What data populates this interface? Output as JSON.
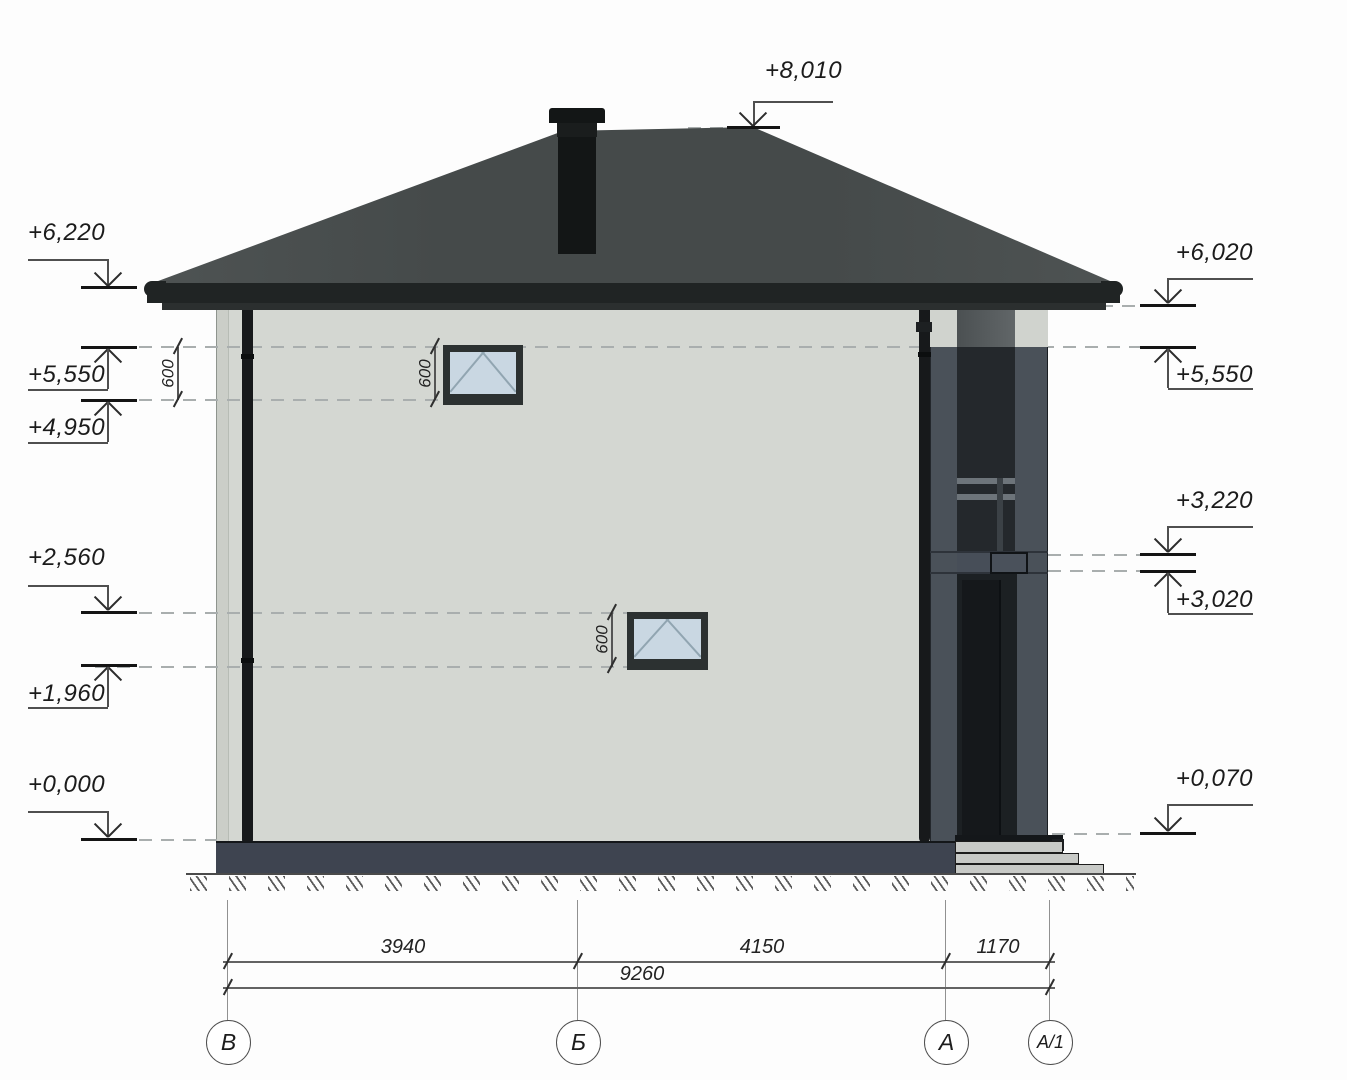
{
  "document": {
    "type": "architectural elevation drawing",
    "subject": "two-storey house side elevation with hip roof, chimney, balcony and entry steps"
  },
  "elevation_markers": {
    "top": {
      "label": "+8,010"
    },
    "left": [
      {
        "label": "+6,220"
      },
      {
        "label": "+5,550"
      },
      {
        "label": "+4,950"
      },
      {
        "label": "+2,560"
      },
      {
        "label": "+1,960"
      },
      {
        "label": "+0,000"
      }
    ],
    "right": [
      {
        "label": "+6,020"
      },
      {
        "label": "+5,550"
      },
      {
        "label": "+3,220"
      },
      {
        "label": "+3,020"
      },
      {
        "label": "+0,070"
      }
    ]
  },
  "detail_dimensions": {
    "eave_band": "600",
    "upper_window": "600",
    "lower_window": "600"
  },
  "bottom_dimensions": {
    "segments": [
      {
        "value": "3940"
      },
      {
        "value": "4150"
      },
      {
        "value": "1170"
      }
    ],
    "total": "9260"
  },
  "axis_bubbles": [
    {
      "label": "В"
    },
    {
      "label": "Б"
    },
    {
      "label": "А"
    },
    {
      "label": "А/1"
    }
  ],
  "colors": {
    "facade": "#d4d7d2",
    "roof": "#474c4c",
    "trim_dark": "#1f2323",
    "pier_slate": "#4a5159",
    "glass": "#c9d7e2",
    "plinth": "#3e4450",
    "steps": "#c8cac7"
  }
}
